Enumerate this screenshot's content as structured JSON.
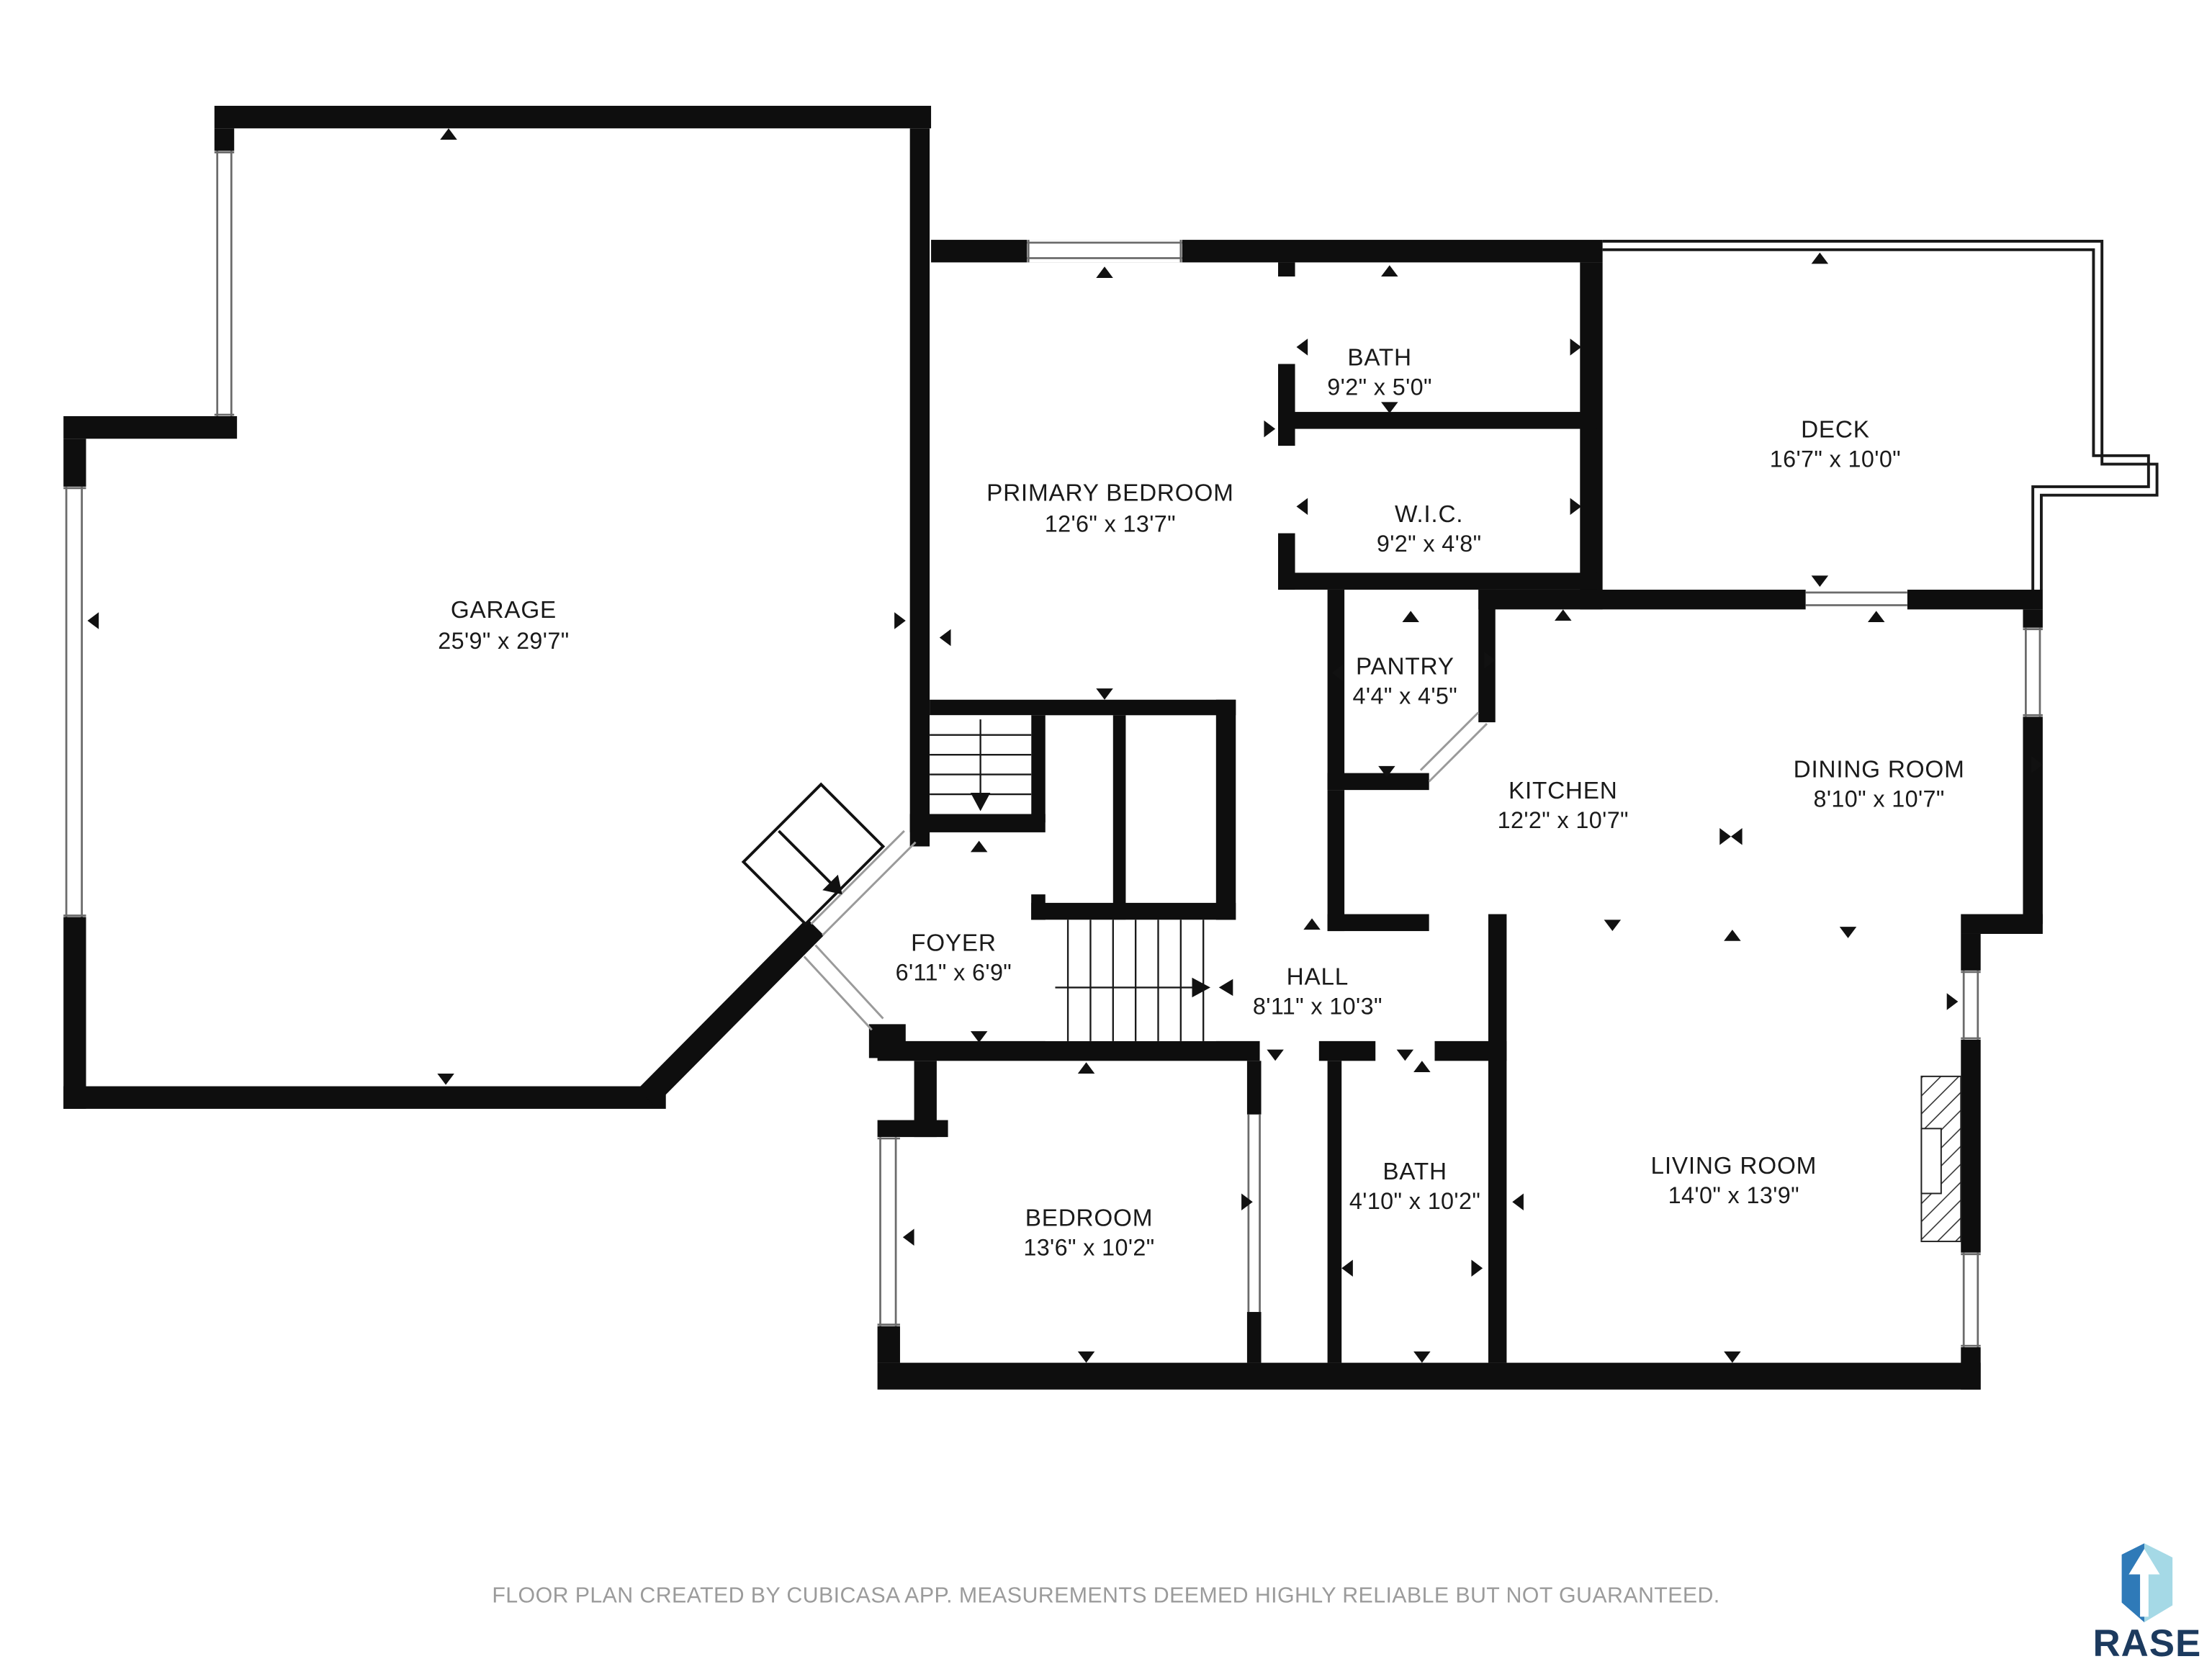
{
  "rooms": [
    {
      "id": "garage",
      "name": "GARAGE",
      "dimensions": "25'9\" x 29'7\""
    },
    {
      "id": "primary-bedroom",
      "name": "PRIMARY BEDROOM",
      "dimensions": "12'6\" x 13'7\""
    },
    {
      "id": "bath-upper",
      "name": "BATH",
      "dimensions": "9'2\" x 5'0\""
    },
    {
      "id": "wic",
      "name": "W.I.C.",
      "dimensions": "9'2\" x 4'8\""
    },
    {
      "id": "deck",
      "name": "DECK",
      "dimensions": "16'7\" x 10'0\""
    },
    {
      "id": "pantry",
      "name": "PANTRY",
      "dimensions": "4'4\" x 4'5\""
    },
    {
      "id": "kitchen",
      "name": "KITCHEN",
      "dimensions": "12'2\" x 10'7\""
    },
    {
      "id": "dining-room",
      "name": "DINING ROOM",
      "dimensions": "8'10\" x 10'7\""
    },
    {
      "id": "foyer",
      "name": "FOYER",
      "dimensions": "6'11\" x 6'9\""
    },
    {
      "id": "hall",
      "name": "HALL",
      "dimensions": "8'11\" x 10'3\""
    },
    {
      "id": "bedroom",
      "name": "BEDROOM",
      "dimensions": "13'6\" x 10'2\""
    },
    {
      "id": "bath-lower",
      "name": "BATH",
      "dimensions": "4'10\" x 10'2\""
    },
    {
      "id": "living-room",
      "name": "LIVING ROOM",
      "dimensions": "14'0\" x 13'9\""
    }
  ],
  "footer": {
    "disclaimer": "FLOOR PLAN CREATED BY CUBICASA APP. MEASUREMENTS DEEMED HIGHLY RELIABLE BUT NOT GUARANTEED."
  },
  "branding": {
    "name": "RASE",
    "colors": {
      "navy": "#1c3a5e",
      "blue": "#2f7ab8",
      "light_blue": "#a5d9e6"
    }
  },
  "plan": {
    "wall_color": "#0e0e0e",
    "text_color": "#1a1a1a",
    "footer_color": "#9b9b9b",
    "background": "#ffffff"
  }
}
